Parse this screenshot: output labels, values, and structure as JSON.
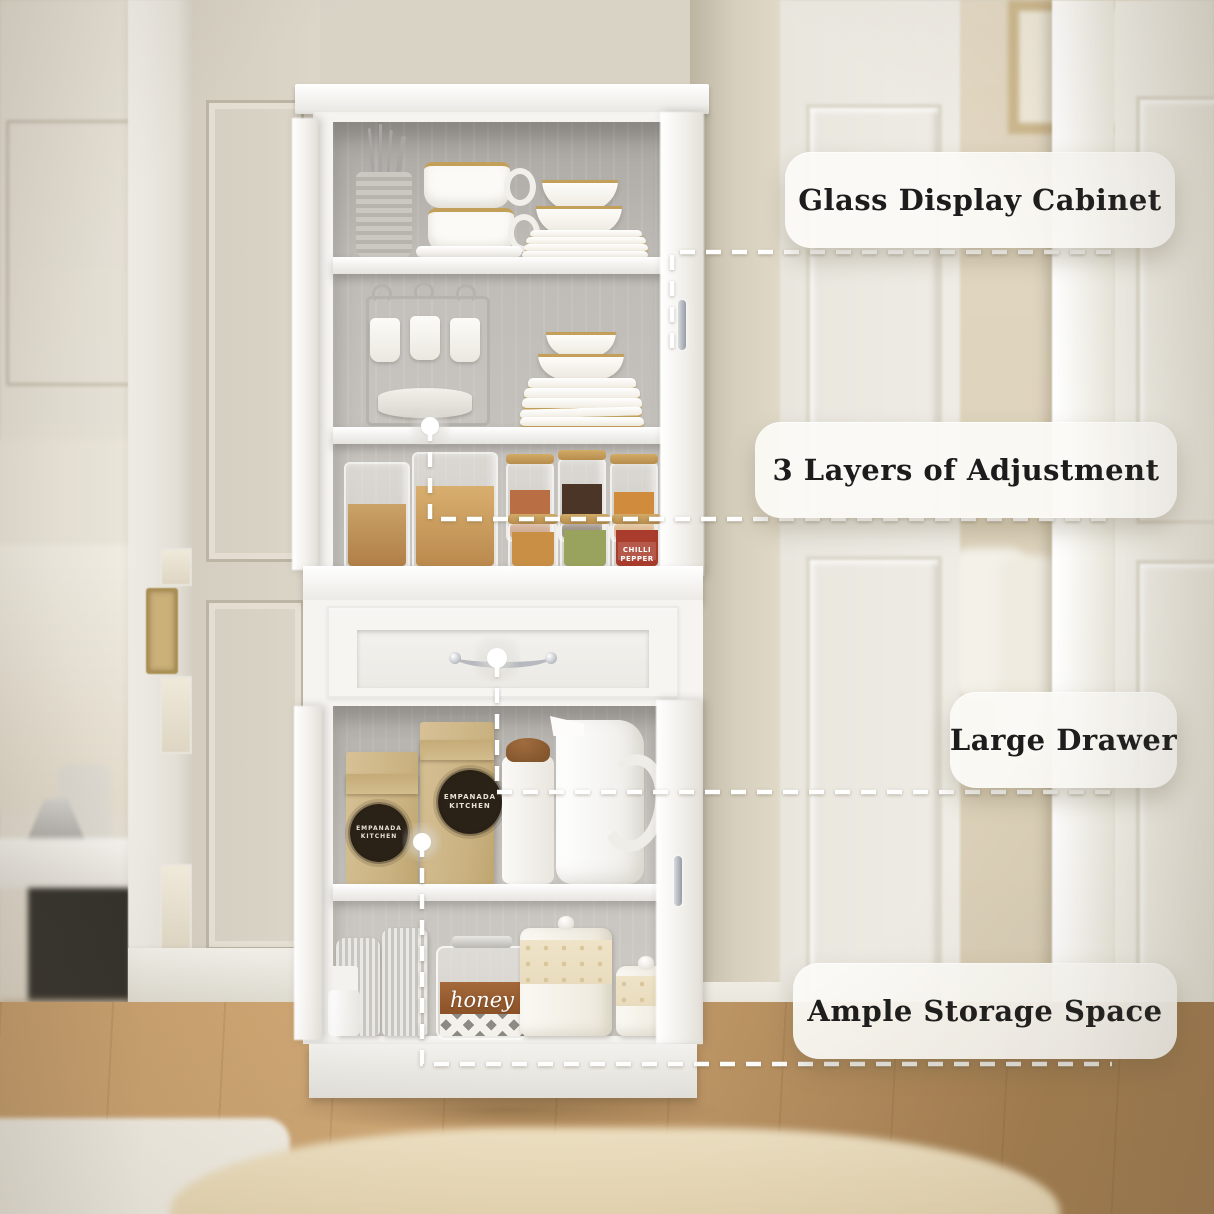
{
  "callouts": [
    {
      "label": "Glass Display Cabinet"
    },
    {
      "label": "3 Layers of Adjustment"
    },
    {
      "label": "Large Drawer"
    },
    {
      "label": "Ample Storage Space"
    }
  ],
  "texts": {
    "bag_line1": "EMPANADA",
    "bag_line2": "KITCHEN",
    "honey": "honey",
    "chilli_line1": "CHILLI",
    "chilli_line2": "PEPPER"
  },
  "colors": {
    "wall": "#d9d3c6",
    "cabinet_white": "#f5f4f1",
    "interior": "#bfbcb7",
    "wood_light": "#c89e6b",
    "wood_dark": "#a37c4e",
    "rug_beige": "#efe2c4",
    "rug_white": "#f2eee5",
    "kraft": "#d7c196",
    "gold": "#c2a05a",
    "connector": "#ffffff",
    "label_text": "#1c1c1c"
  }
}
